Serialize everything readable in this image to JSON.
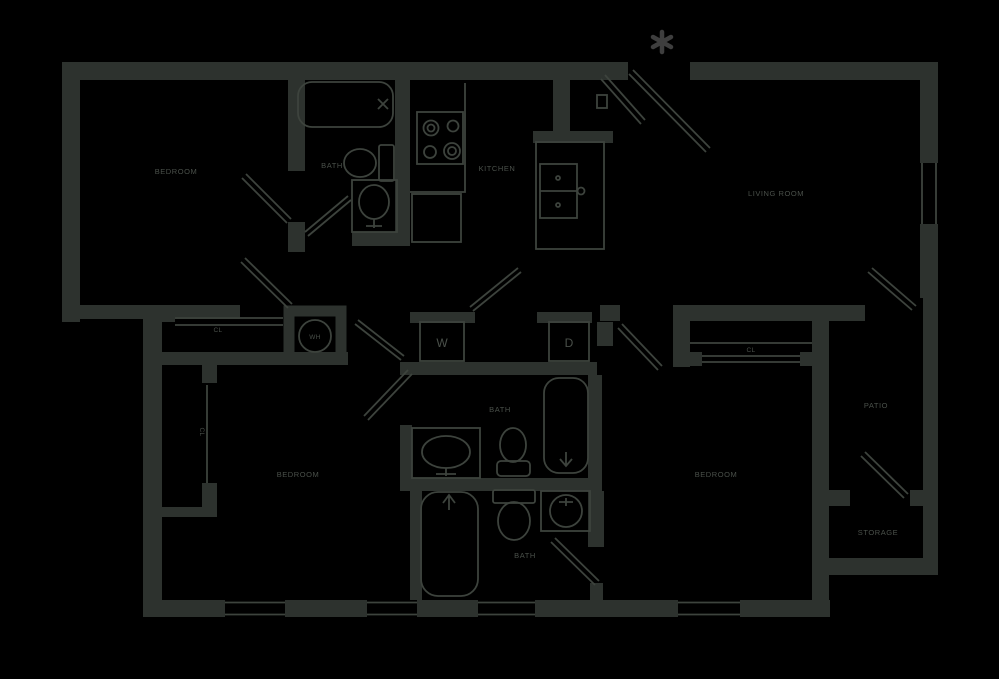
{
  "colors": {
    "background": "#000000",
    "wall": "#2d322e",
    "line": "#3d433d",
    "text": "#4a504a",
    "marker": "#3e3e3e"
  },
  "rooms": {
    "bedroom_top_left": "BEDROOM",
    "bath_top": "BATH",
    "kitchen": "KITCHEN",
    "living_room": "LIVING ROOM",
    "bedroom_bottom_left": "BEDROOM",
    "bath_middle": "BATH",
    "bath_bottom": "BATH",
    "bedroom_bottom_right": "BEDROOM",
    "patio": "PATIO",
    "storage": "STORAGE"
  },
  "fixtures": {
    "washer": "W",
    "dryer": "D",
    "water_heater": "WH",
    "closet_hall": "CL",
    "closet_bedroom_left": "CL",
    "closet_bedroom_right": "CL"
  },
  "entry_marker": "*"
}
